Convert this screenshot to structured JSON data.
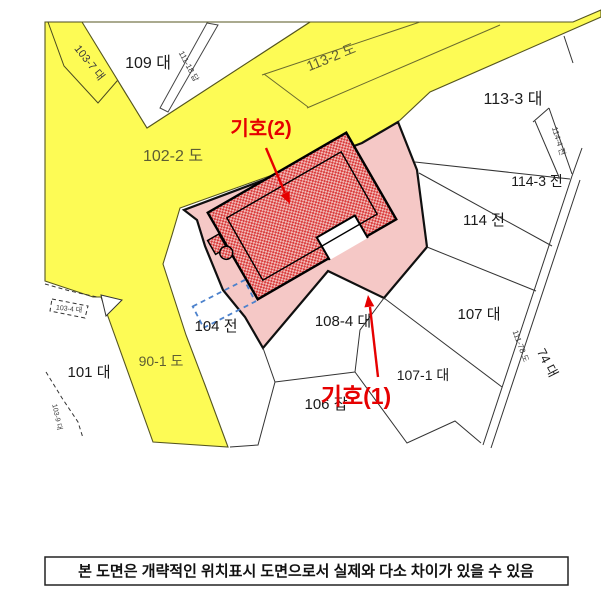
{
  "parcels": {
    "p109": "109 대",
    "p103_7": "103-7 대",
    "p111_18": "111-18 답",
    "p113_2": "113-2 도",
    "p102_2": "102-2 도",
    "p113_3": "113-3 대",
    "p114_3": "114-3 전",
    "p114_4": "114-4 전",
    "p114": "114 전",
    "p107": "107 대",
    "p74": "74 대",
    "p111_78": "111-78 도",
    "p107_1": "107-1 대",
    "p108_4": "108-4 대",
    "p104": "104 전",
    "p106": "106 잡",
    "p101": "101 대",
    "p90_1": "90-1 도",
    "p103_4": "103-4 대",
    "p103_9": "103-9 대"
  },
  "annotations": {
    "marker2": "기호(2)",
    "marker1": "기호(1)",
    "color": "#e60000"
  },
  "disclaimer": "본 도면은 개략적인 위치표시 도면으로서 실제와 다소 차이가 있을 수 있음",
  "colors": {
    "road_yellow": "#fdfb55",
    "parcel_pink": "#f5c8c6",
    "building_hatch_red": "#d93b3b",
    "boundary": "#333333",
    "marker_red": "#e60000",
    "guide_blue": "#4d82cc"
  }
}
